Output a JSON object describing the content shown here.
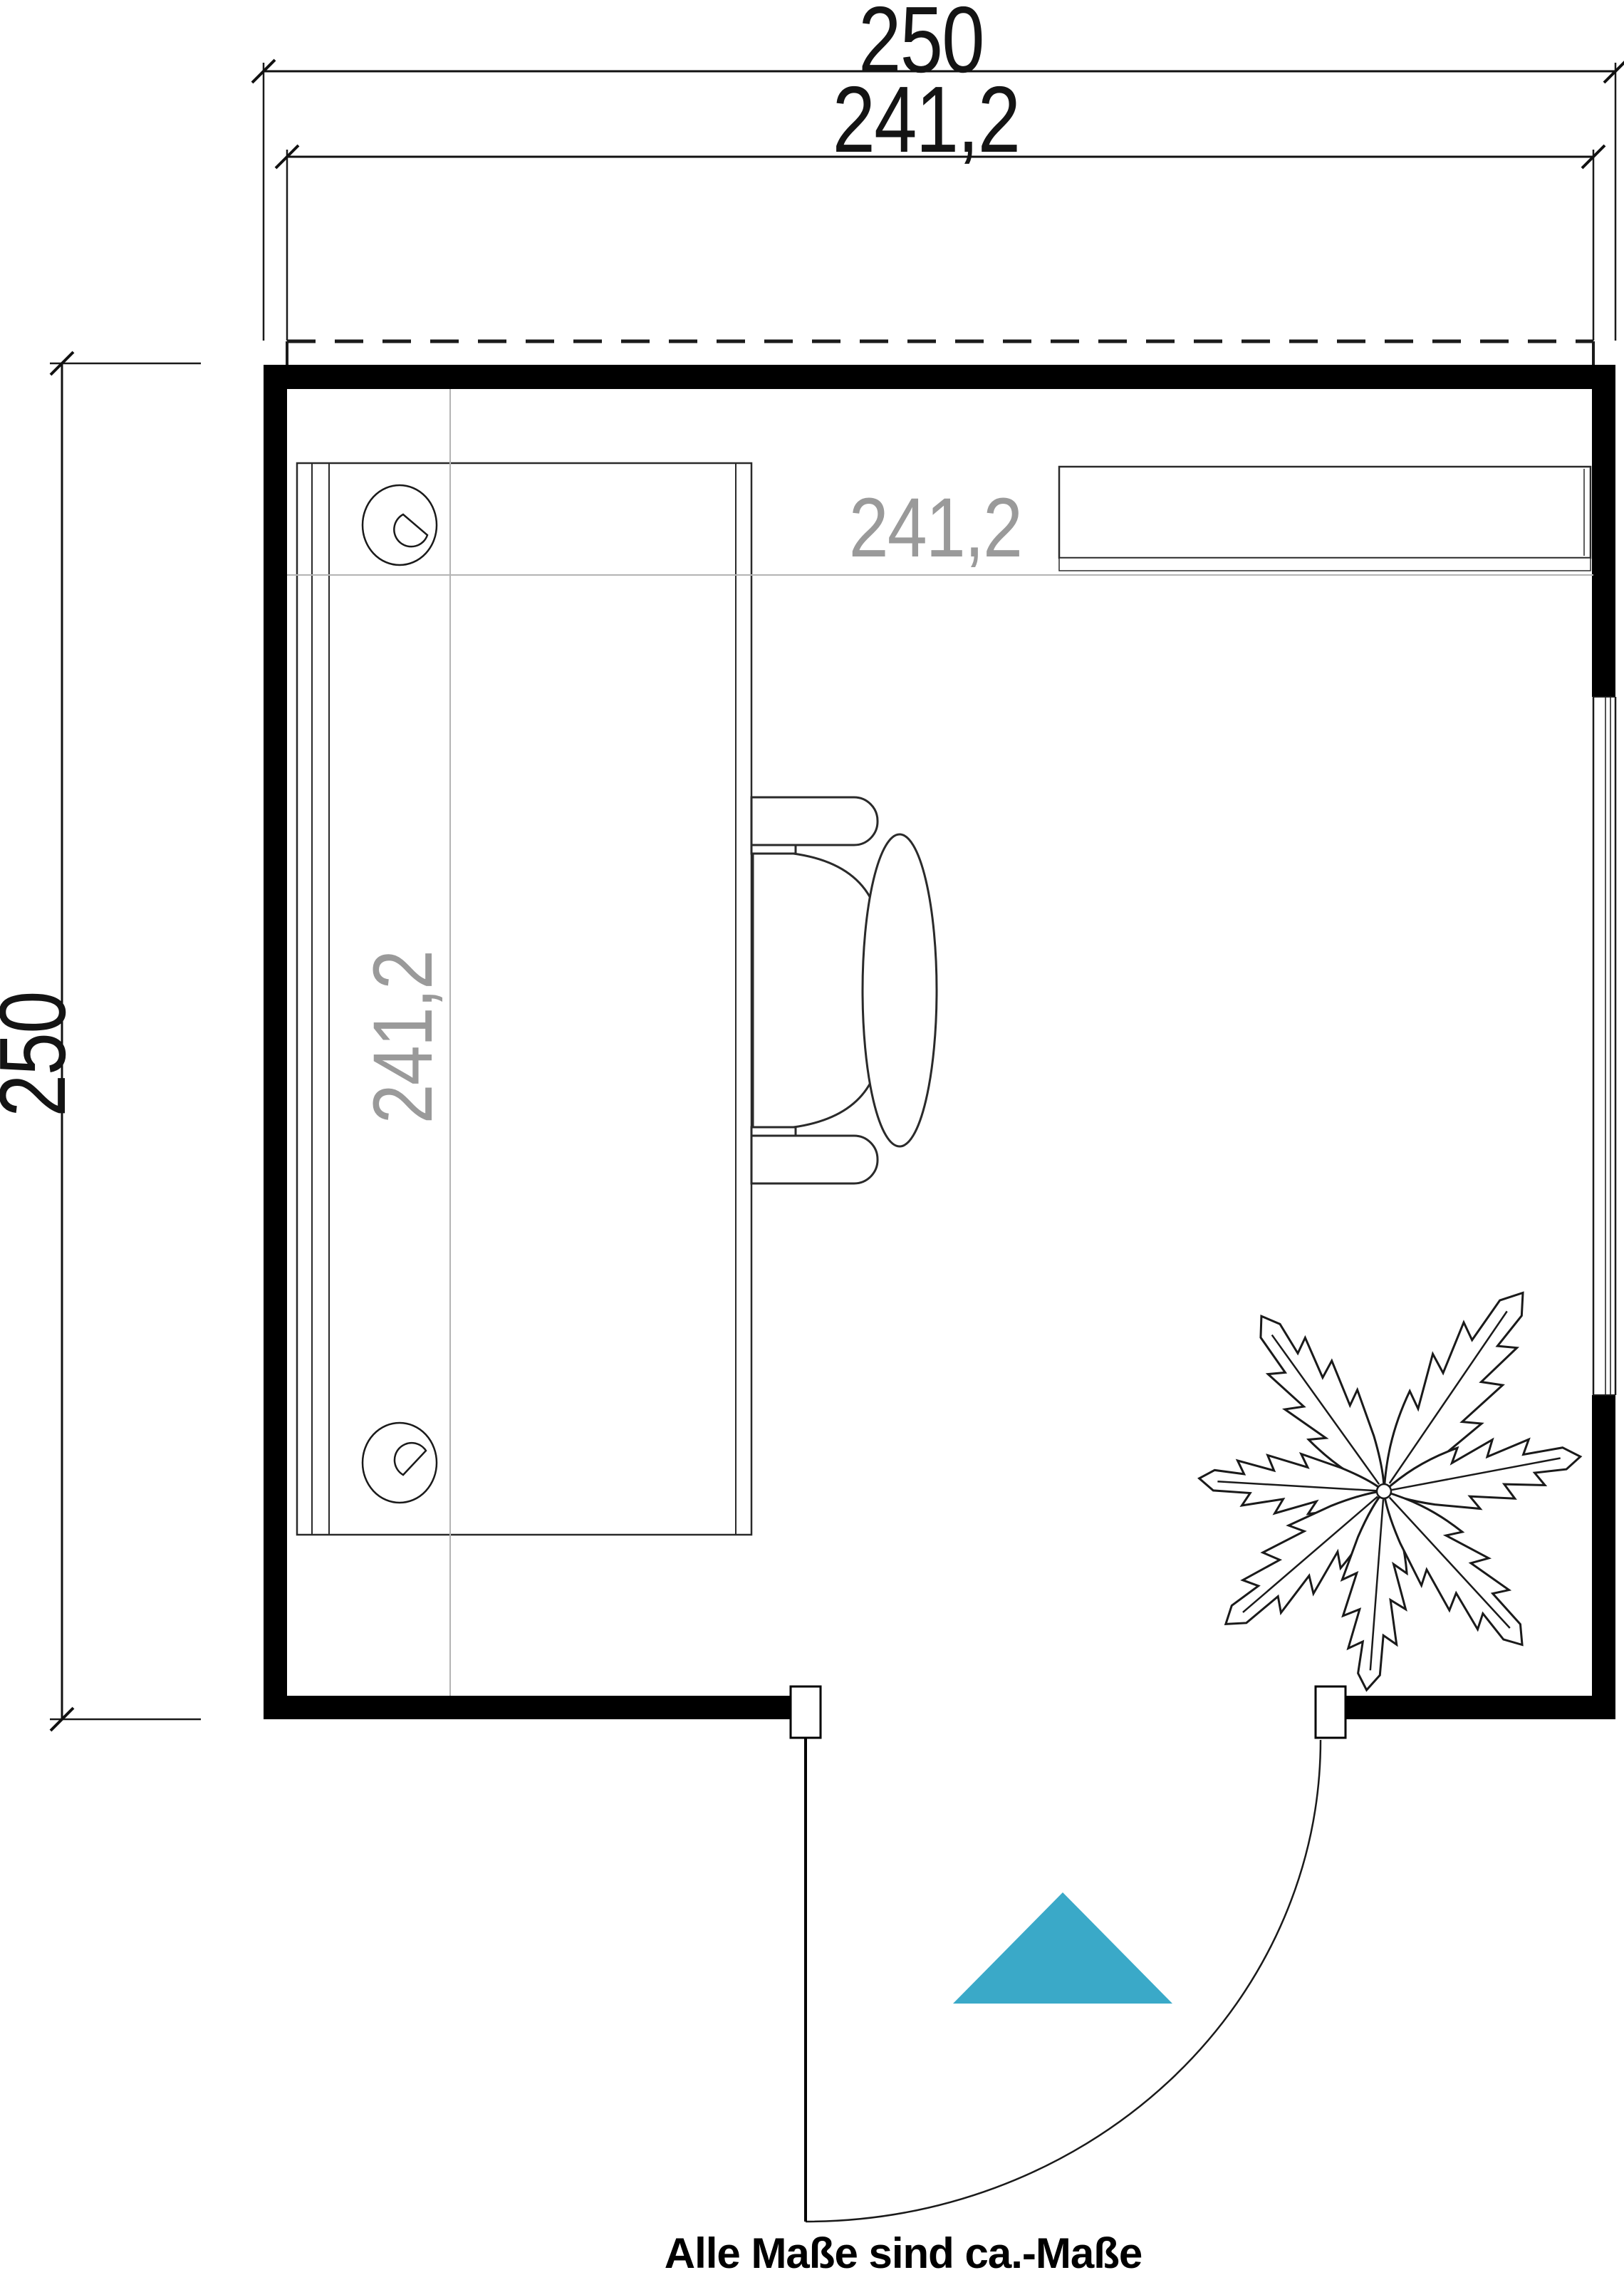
{
  "dimensions": {
    "top_outer_width": "250",
    "top_inner_width": "241,2",
    "left_height": "250",
    "interior_width": "241,2",
    "interior_depth": "241,2"
  },
  "footer": {
    "note": "Alle Maße sind ca.-Maße"
  },
  "colors": {
    "entrance_arrow": "#3AA9C8",
    "interior_dim_text": "#9A9A9A",
    "grid_line": "#B4B4B4",
    "wall": "#000000"
  }
}
